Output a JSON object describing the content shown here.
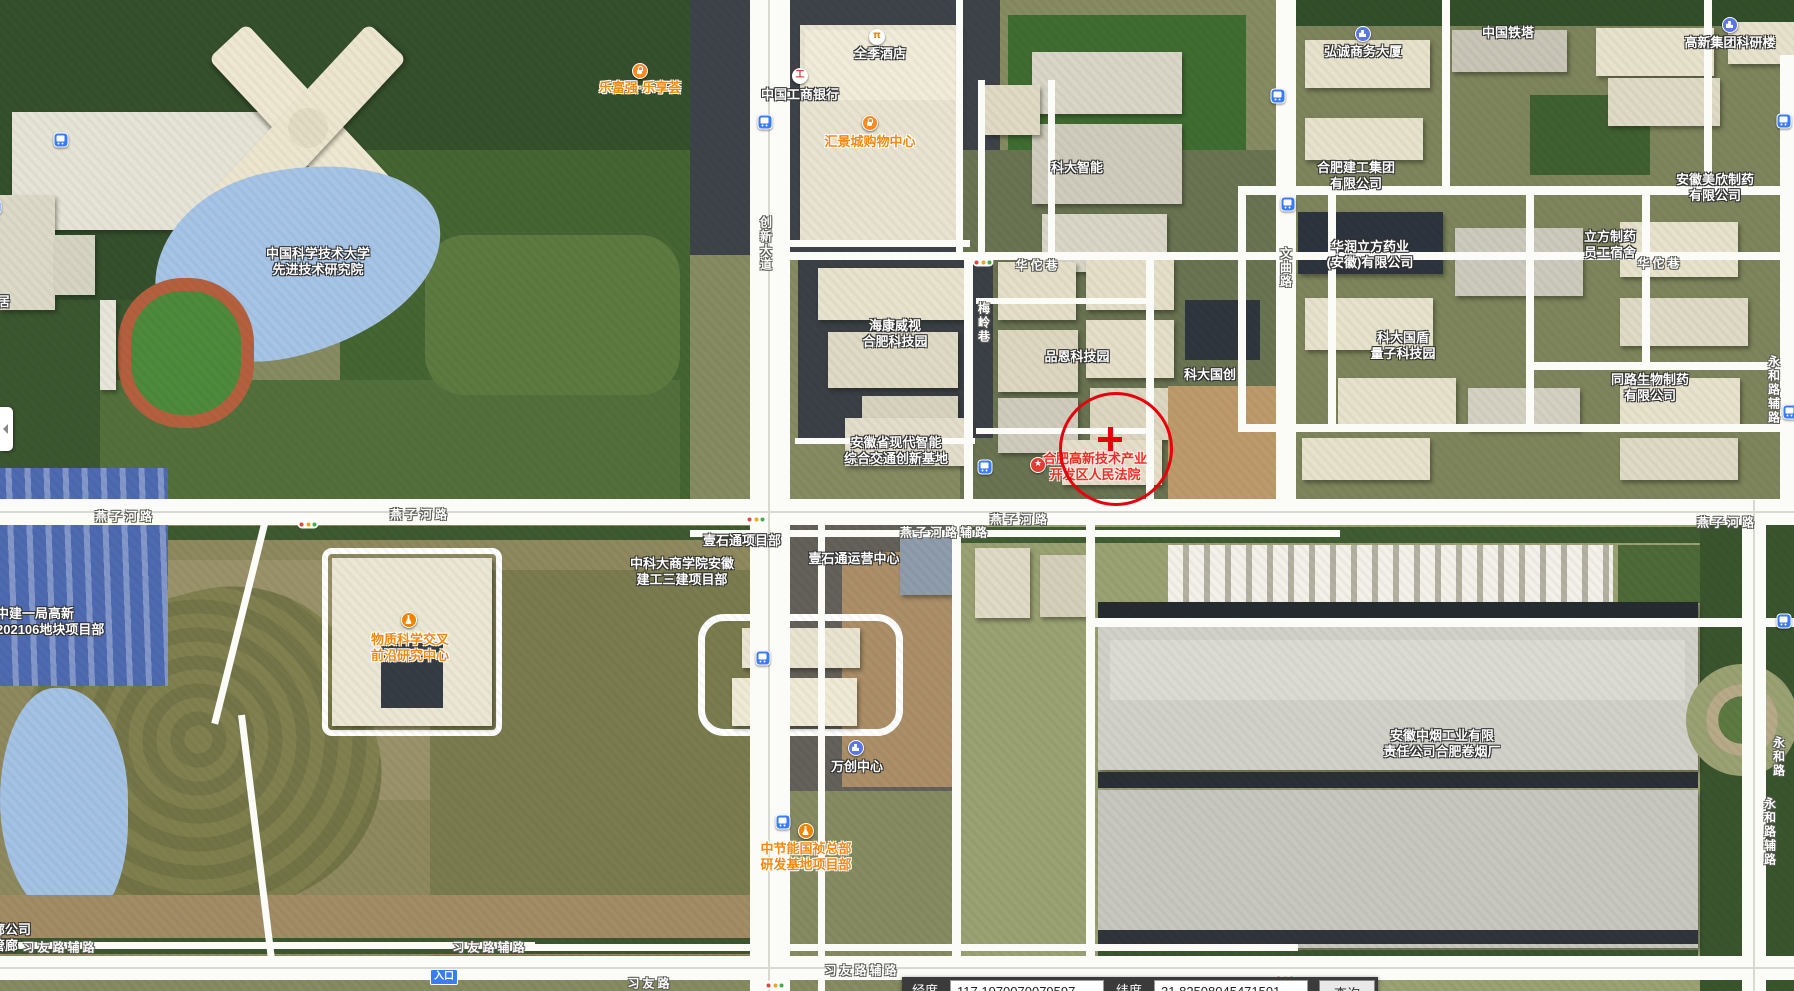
{
  "map": {
    "poi_labels": [
      {
        "name": "ustc-advanced-tech-institute",
        "lines": [
          "中国科学技术大学",
          "先进技术研究院"
        ],
        "x": 318,
        "y": 262,
        "style": "white"
      },
      {
        "name": "lefuqiang-lexianghui",
        "lines": [
          "乐富强·乐享荟"
        ],
        "x": 640,
        "y": 88,
        "style": "orange"
      },
      {
        "name": "quanji-hotel",
        "lines": [
          "全季酒店"
        ],
        "x": 880,
        "y": 54,
        "style": "white"
      },
      {
        "name": "icbc-bank",
        "lines": [
          "中国工商银行"
        ],
        "x": 800,
        "y": 95,
        "style": "white"
      },
      {
        "name": "huijingcheng-mall",
        "lines": [
          "汇景城购物中心"
        ],
        "x": 870,
        "y": 142,
        "style": "orange"
      },
      {
        "name": "keda-zhineng",
        "lines": [
          "科大智能"
        ],
        "x": 1077,
        "y": 168,
        "style": "white"
      },
      {
        "name": "hongcheng-business-tower",
        "lines": [
          "弘诚商务大厦"
        ],
        "x": 1363,
        "y": 52,
        "style": "white"
      },
      {
        "name": "china-tower",
        "lines": [
          "中国铁塔"
        ],
        "x": 1508,
        "y": 33,
        "style": "white"
      },
      {
        "name": "gaoxin-group-research-building",
        "lines": [
          "高新集团科研楼"
        ],
        "x": 1730,
        "y": 43,
        "style": "white"
      },
      {
        "name": "hefei-construction-group",
        "lines": [
          "合肥建工集团",
          "有限公司"
        ],
        "x": 1356,
        "y": 176,
        "style": "white"
      },
      {
        "name": "huarun-lifang-pharma",
        "lines": [
          "华润立方药业",
          "(安徽)有限公司"
        ],
        "x": 1370,
        "y": 255,
        "style": "white"
      },
      {
        "name": "lifang-pharma-dorm",
        "lines": [
          "立方制药",
          "员工宿舍"
        ],
        "x": 1610,
        "y": 245,
        "style": "white"
      },
      {
        "name": "anhui-meixin-pharma",
        "lines": [
          "安徽美欣制药",
          "有限公司"
        ],
        "x": 1715,
        "y": 188,
        "style": "white"
      },
      {
        "name": "tonglu-bio-pharma",
        "lines": [
          "同路生物制药",
          "有限公司"
        ],
        "x": 1650,
        "y": 388,
        "style": "white"
      },
      {
        "name": "keda-guodun-quantum-park",
        "lines": [
          "科大国盾",
          "量子科技园"
        ],
        "x": 1403,
        "y": 346,
        "style": "white"
      },
      {
        "name": "keda-guochuang",
        "lines": [
          "科大国创"
        ],
        "x": 1210,
        "y": 375,
        "style": "white"
      },
      {
        "name": "pinen-tech-park",
        "lines": [
          "品恩科技园"
        ],
        "x": 1077,
        "y": 357,
        "style": "white"
      },
      {
        "name": "hikvision-hefei-park",
        "lines": [
          "海康威视",
          "合肥科技园"
        ],
        "x": 895,
        "y": 334,
        "style": "white"
      },
      {
        "name": "anhui-smart-transport-base",
        "lines": [
          "安徽省现代智能",
          "综合交通创新基地"
        ],
        "x": 896,
        "y": 451,
        "style": "white"
      },
      {
        "name": "hefei-hitech-court",
        "lines": [
          "合肥高新技术产业",
          "开发区人民法院"
        ],
        "x": 1095,
        "y": 467,
        "style": "red"
      },
      {
        "name": "material-science-center",
        "lines": [
          "物质科学交叉",
          "前沿研究中心"
        ],
        "x": 410,
        "y": 648,
        "style": "orange"
      },
      {
        "name": "zhongjian-project-dept",
        "lines": [
          "中建一局高新",
          "202106地块项目部"
        ],
        "x": -4,
        "y": 622,
        "style": "white",
        "anchor": "left"
      },
      {
        "name": "yishitong-project-dept",
        "lines": [
          "壹石通项目部"
        ],
        "x": 742,
        "y": 541,
        "style": "white"
      },
      {
        "name": "yishitong-ops-center",
        "lines": [
          "壹石通运营中心"
        ],
        "x": 854,
        "y": 559,
        "style": "white"
      },
      {
        "name": "zhongkeda-business-school-dept",
        "lines": [
          "中科大商学院安徽",
          "建工三建项目部"
        ],
        "x": 682,
        "y": 572,
        "style": "white"
      },
      {
        "name": "wanchuang-center",
        "lines": [
          "万创中心"
        ],
        "x": 857,
        "y": 767,
        "style": "white"
      },
      {
        "name": "zhongjieneng-guozhen-hq",
        "lines": [
          "中节能国祯总部",
          "研发基地项目部"
        ],
        "x": 806,
        "y": 857,
        "style": "orange"
      },
      {
        "name": "anhui-tobacco-factory",
        "lines": [
          "安徽中烟工业有限",
          "责任公司合肥卷烟厂"
        ],
        "x": 1442,
        "y": 744,
        "style": "white"
      },
      {
        "name": "partial-langongsi",
        "lines": [
          "廊公司",
          "管廊"
        ],
        "x": -8,
        "y": 938,
        "style": "white",
        "anchor": "left"
      },
      {
        "name": "partial-ju",
        "lines": [
          "居"
        ],
        "x": -3,
        "y": 302,
        "style": "white",
        "anchor": "left"
      }
    ],
    "road_labels": [
      {
        "name": "yanzihe-rd-1",
        "text": "燕子河路",
        "x": 125,
        "y": 516,
        "vertical": false
      },
      {
        "name": "yanzihe-rd-2",
        "text": "燕子河路",
        "x": 420,
        "y": 514,
        "vertical": false
      },
      {
        "name": "yanzihe-rd-3",
        "text": "燕子河路",
        "x": 1020,
        "y": 519,
        "vertical": false
      },
      {
        "name": "yanzihe-rd-4",
        "text": "燕子河路",
        "x": 1727,
        "y": 522,
        "vertical": false
      },
      {
        "name": "yanzihe-service-rd",
        "text": "燕子河路辅路",
        "x": 945,
        "y": 532,
        "vertical": false
      },
      {
        "name": "huatuo-lane-1",
        "text": "华佗巷",
        "x": 1038,
        "y": 265,
        "vertical": false
      },
      {
        "name": "huatuo-lane-2",
        "text": "华佗巷",
        "x": 1660,
        "y": 263,
        "vertical": false
      },
      {
        "name": "chuangxin-ave",
        "text": "创新大道",
        "x": 766,
        "y": 244,
        "vertical": true
      },
      {
        "name": "meiling-lane",
        "text": "梅岭巷",
        "x": 984,
        "y": 323,
        "vertical": true
      },
      {
        "name": "wenqu-rd",
        "text": "文曲路",
        "x": 1286,
        "y": 268,
        "vertical": true
      },
      {
        "name": "yonghe-rd",
        "text": "永和路",
        "x": 1779,
        "y": 757,
        "vertical": true
      },
      {
        "name": "yonghe-service-rd-1",
        "text": "永和路辅路",
        "x": 1774,
        "y": 390,
        "vertical": true
      },
      {
        "name": "yonghe-service-rd-2",
        "text": "永和路辅路",
        "x": 1770,
        "y": 832,
        "vertical": true
      },
      {
        "name": "xiyou-service-rd-1",
        "text": "习友路辅路",
        "x": 60,
        "y": 947,
        "vertical": false
      },
      {
        "name": "xiyou-service-rd-2",
        "text": "习友路辅路",
        "x": 490,
        "y": 947,
        "vertical": false
      },
      {
        "name": "xiyou-service-rd-3",
        "text": "习友路辅路",
        "x": 862,
        "y": 970,
        "vertical": false
      },
      {
        "name": "xiyou-rd-1",
        "text": "习友路",
        "x": 650,
        "y": 983,
        "vertical": false
      },
      {
        "name": "xiyou-rd-2",
        "text": "习友路",
        "x": 1236,
        "y": 985,
        "vertical": false
      }
    ],
    "poi_icons": [
      {
        "type": "bag",
        "name": "shopping-icon-lefuqiang",
        "x": 640,
        "y": 71
      },
      {
        "type": "hotel",
        "name": "hotel-icon-quanji",
        "x": 877,
        "y": 37
      },
      {
        "type": "bank",
        "name": "bank-icon-icbc",
        "x": 800,
        "y": 76
      },
      {
        "type": "bag",
        "name": "shopping-icon-mall",
        "x": 870,
        "y": 123
      },
      {
        "type": "bldg",
        "name": "building-icon-hongcheng",
        "x": 1363,
        "y": 34
      },
      {
        "type": "bldg",
        "name": "building-icon-gaoxin",
        "x": 1730,
        "y": 25
      },
      {
        "type": "star",
        "name": "court-star-icon",
        "x": 1038,
        "y": 465
      },
      {
        "type": "flask",
        "name": "project-icon-material-center",
        "x": 409,
        "y": 620
      },
      {
        "type": "bldg",
        "name": "building-icon-wanchuang",
        "x": 856,
        "y": 748
      },
      {
        "type": "flask",
        "name": "project-icon-zhongjieneng",
        "x": 806,
        "y": 831
      }
    ],
    "bus_stops": [
      {
        "x": 61,
        "y": 140
      },
      {
        "x": -6,
        "y": 207
      },
      {
        "x": 765,
        "y": 122
      },
      {
        "x": 1278,
        "y": 96
      },
      {
        "x": 1288,
        "y": 204
      },
      {
        "x": 985,
        "y": 467
      },
      {
        "x": 763,
        "y": 658
      },
      {
        "x": 783,
        "y": 822
      },
      {
        "x": 1784,
        "y": 621
      },
      {
        "x": 1790,
        "y": 412
      },
      {
        "x": 1784,
        "y": 121
      }
    ],
    "traffic_lights": [
      {
        "x": 308,
        "y": 524
      },
      {
        "x": 983,
        "y": 262
      },
      {
        "x": 756,
        "y": 519
      },
      {
        "x": 775,
        "y": 985
      },
      {
        "x": 1285,
        "y": 978
      }
    ],
    "target_marker": {
      "cx": 1113,
      "cy": 446,
      "r": 54,
      "cross_x": 1110,
      "cross_y": 439
    },
    "entrance_badge": {
      "label": "入口",
      "x": 444,
      "y": 977
    },
    "panel_toggle": {
      "x": 0,
      "y": 407
    },
    "status_bar": {
      "x": 902,
      "y": 977,
      "lng_label": "经度",
      "lng_value": "117.1970070079597",
      "lat_label": "纬度",
      "lat_value": "31.82508045471501",
      "search_label": "查询"
    },
    "colors": {
      "road": "#fbfbf8",
      "water": "#a6c4e6",
      "poi_orange": "#f5880f",
      "poi_red": "#ee2f23",
      "bus_blue": "#3a7bf6",
      "marker_red": "#e8000a"
    }
  }
}
